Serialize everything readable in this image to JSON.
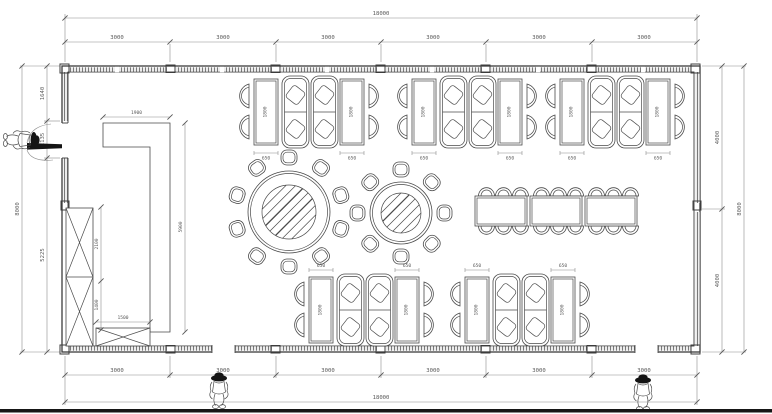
{
  "drawing": {
    "background": "#ffffff",
    "line_color": "#3c3c3c",
    "dim_line_color": "#8d8d8d",
    "text_color": "#5a5a5a",
    "bottom_bar_color": "#161616",
    "icons": {
      "person": "walking-person-with-hat"
    }
  },
  "dims": {
    "top": {
      "overall": "18000",
      "segments": [
        "3000",
        "3000",
        "3000",
        "3000",
        "3000",
        "3000"
      ]
    },
    "bottom": {
      "overall": "18000",
      "segments": [
        "3000",
        "3000",
        "3000",
        "3000",
        "3000",
        "3000"
      ]
    },
    "left": {
      "overall": "8000",
      "segments": [
        "1640",
        "1135",
        "5225"
      ]
    },
    "right": {
      "overall": "8000",
      "segments": [
        "4000",
        "4000"
      ]
    },
    "interior": {
      "counter_top_width": "1900",
      "counter_length": "5900",
      "cabinet_upper": "2100",
      "cabinet_lower": "1400",
      "base_cabinet_width": "1500",
      "booth_table_length": "1800",
      "booth_table_width": "650"
    }
  }
}
